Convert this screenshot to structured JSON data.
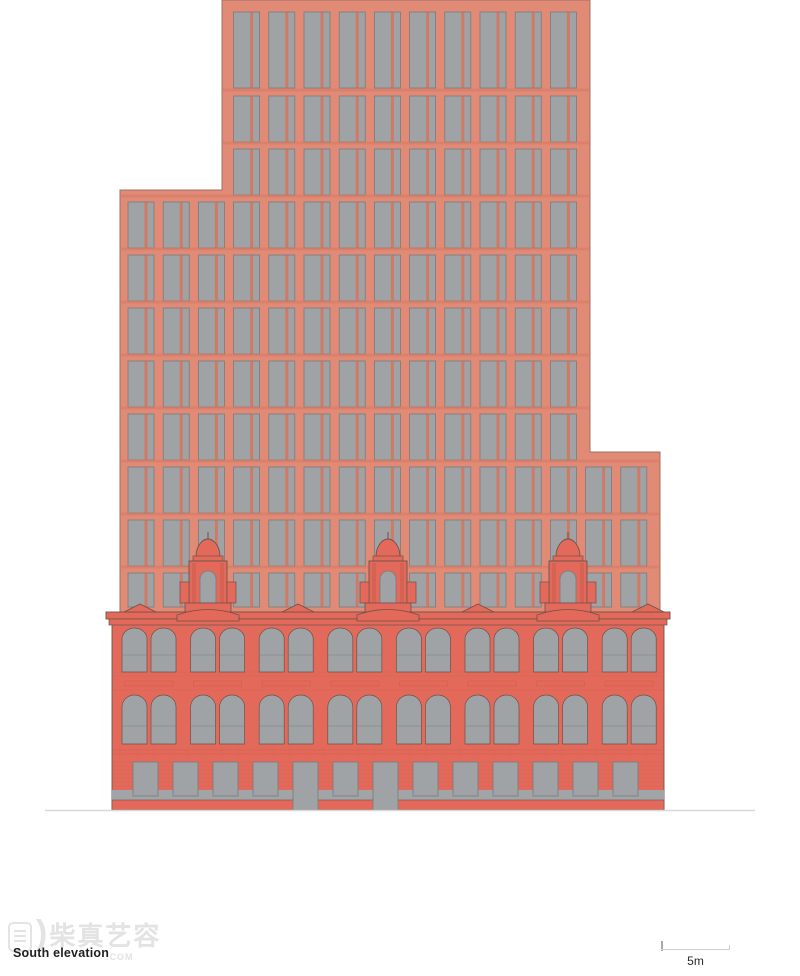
{
  "page": {
    "width": 800,
    "height": 976,
    "background": "#FFFFFF"
  },
  "caption": {
    "text": "South elevation"
  },
  "scale_bar": {
    "label": "5m",
    "x1": 661,
    "x2": 730,
    "y": 950
  },
  "watermark": {
    "cjk": "柴真艺容",
    "suffix": ".COM",
    "icon": "stamp-logo-icon",
    "arc": ")"
  },
  "colors": {
    "tower_facade": "#E18B77",
    "tower_accent": "#D5765F",
    "tower_outline": "#9C7263",
    "window_glass": "#A0A3A5",
    "window_frame": "#787B7D",
    "base_facade": "#E36A5A",
    "base_shade": "#C85949",
    "base_outline": "#6C524B",
    "ground_strip": "#A2A5A7",
    "ground_line": "#D8D8D8",
    "scalebar_line": "#CFCFCF",
    "scalebar_tick": "#A8A8A8",
    "caption_color": "#1F1F1F",
    "scale_label_color": "#2A2A2A",
    "watermark_color": "#E3E3E3"
  },
  "drawing": {
    "tower": {
      "polygon": "222,0 590,0 590,452 660,452 660,612 120,612 120,190 222,190"
    },
    "grid": {
      "col_start": 128,
      "col_pitch": 35.2,
      "win_w": 26,
      "mullion_x": 16.5,
      "mullion_w": 3,
      "rows": [
        {
          "y": 12,
          "h": 76,
          "c0": 3,
          "c1": 12
        },
        {
          "y": 96,
          "h": 46,
          "c0": 3,
          "c1": 12
        },
        {
          "y": 149,
          "h": 46,
          "c0": 3,
          "c1": 12
        },
        {
          "y": 202,
          "h": 46,
          "c0": 0,
          "c1": 12
        },
        {
          "y": 255,
          "h": 46,
          "c0": 0,
          "c1": 12
        },
        {
          "y": 308,
          "h": 46,
          "c0": 0,
          "c1": 12
        },
        {
          "y": 361,
          "h": 46,
          "c0": 0,
          "c1": 12
        },
        {
          "y": 414,
          "h": 46,
          "c0": 0,
          "c1": 12
        },
        {
          "y": 467,
          "h": 46,
          "c0": 0,
          "c1": 14
        },
        {
          "y": 520,
          "h": 46,
          "c0": 0,
          "c1": 14
        },
        {
          "y": 573,
          "h": 34,
          "c0": 0,
          "c1": 14
        }
      ]
    },
    "base": {
      "wall": {
        "x": 112,
        "w": 552,
        "top": 624,
        "bottom": 810
      },
      "cornice": {
        "x": 106,
        "w": 564,
        "y": 612,
        "h": 7,
        "sub_y": 619,
        "sub_x": 109,
        "sub_w": 558,
        "sub_h": 6
      },
      "arch_pair_start": 122,
      "pair_pitch": 68.6,
      "pair_offset": 29,
      "arch_w": 25,
      "pairs": 8,
      "arch_rows": [
        {
          "y": 628,
          "h": 44,
          "r": 11,
          "transom": 655
        },
        {
          "y": 695,
          "h": 49,
          "r": 12,
          "transom": 726
        }
      ],
      "panel_band": {
        "y": 681,
        "h": 5
      },
      "rustic": {
        "y": 746,
        "h": 12
      },
      "ground": {
        "open_y": 762,
        "open_h": 34,
        "start": 133,
        "pitch": 40,
        "w": 25,
        "count": 13,
        "doors": [
          4,
          6
        ],
        "door_h": 48
      },
      "sill_strip": {
        "y": 790,
        "h": 10
      },
      "bottom_strip": {
        "y": 800,
        "h": 10
      }
    },
    "turrets": {
      "centers": [
        208,
        388,
        568
      ]
    },
    "pediments": [
      140,
      298,
      478,
      648
    ],
    "ground_line": {
      "x1": 45,
      "x2": 755,
      "y": 810.5
    }
  }
}
